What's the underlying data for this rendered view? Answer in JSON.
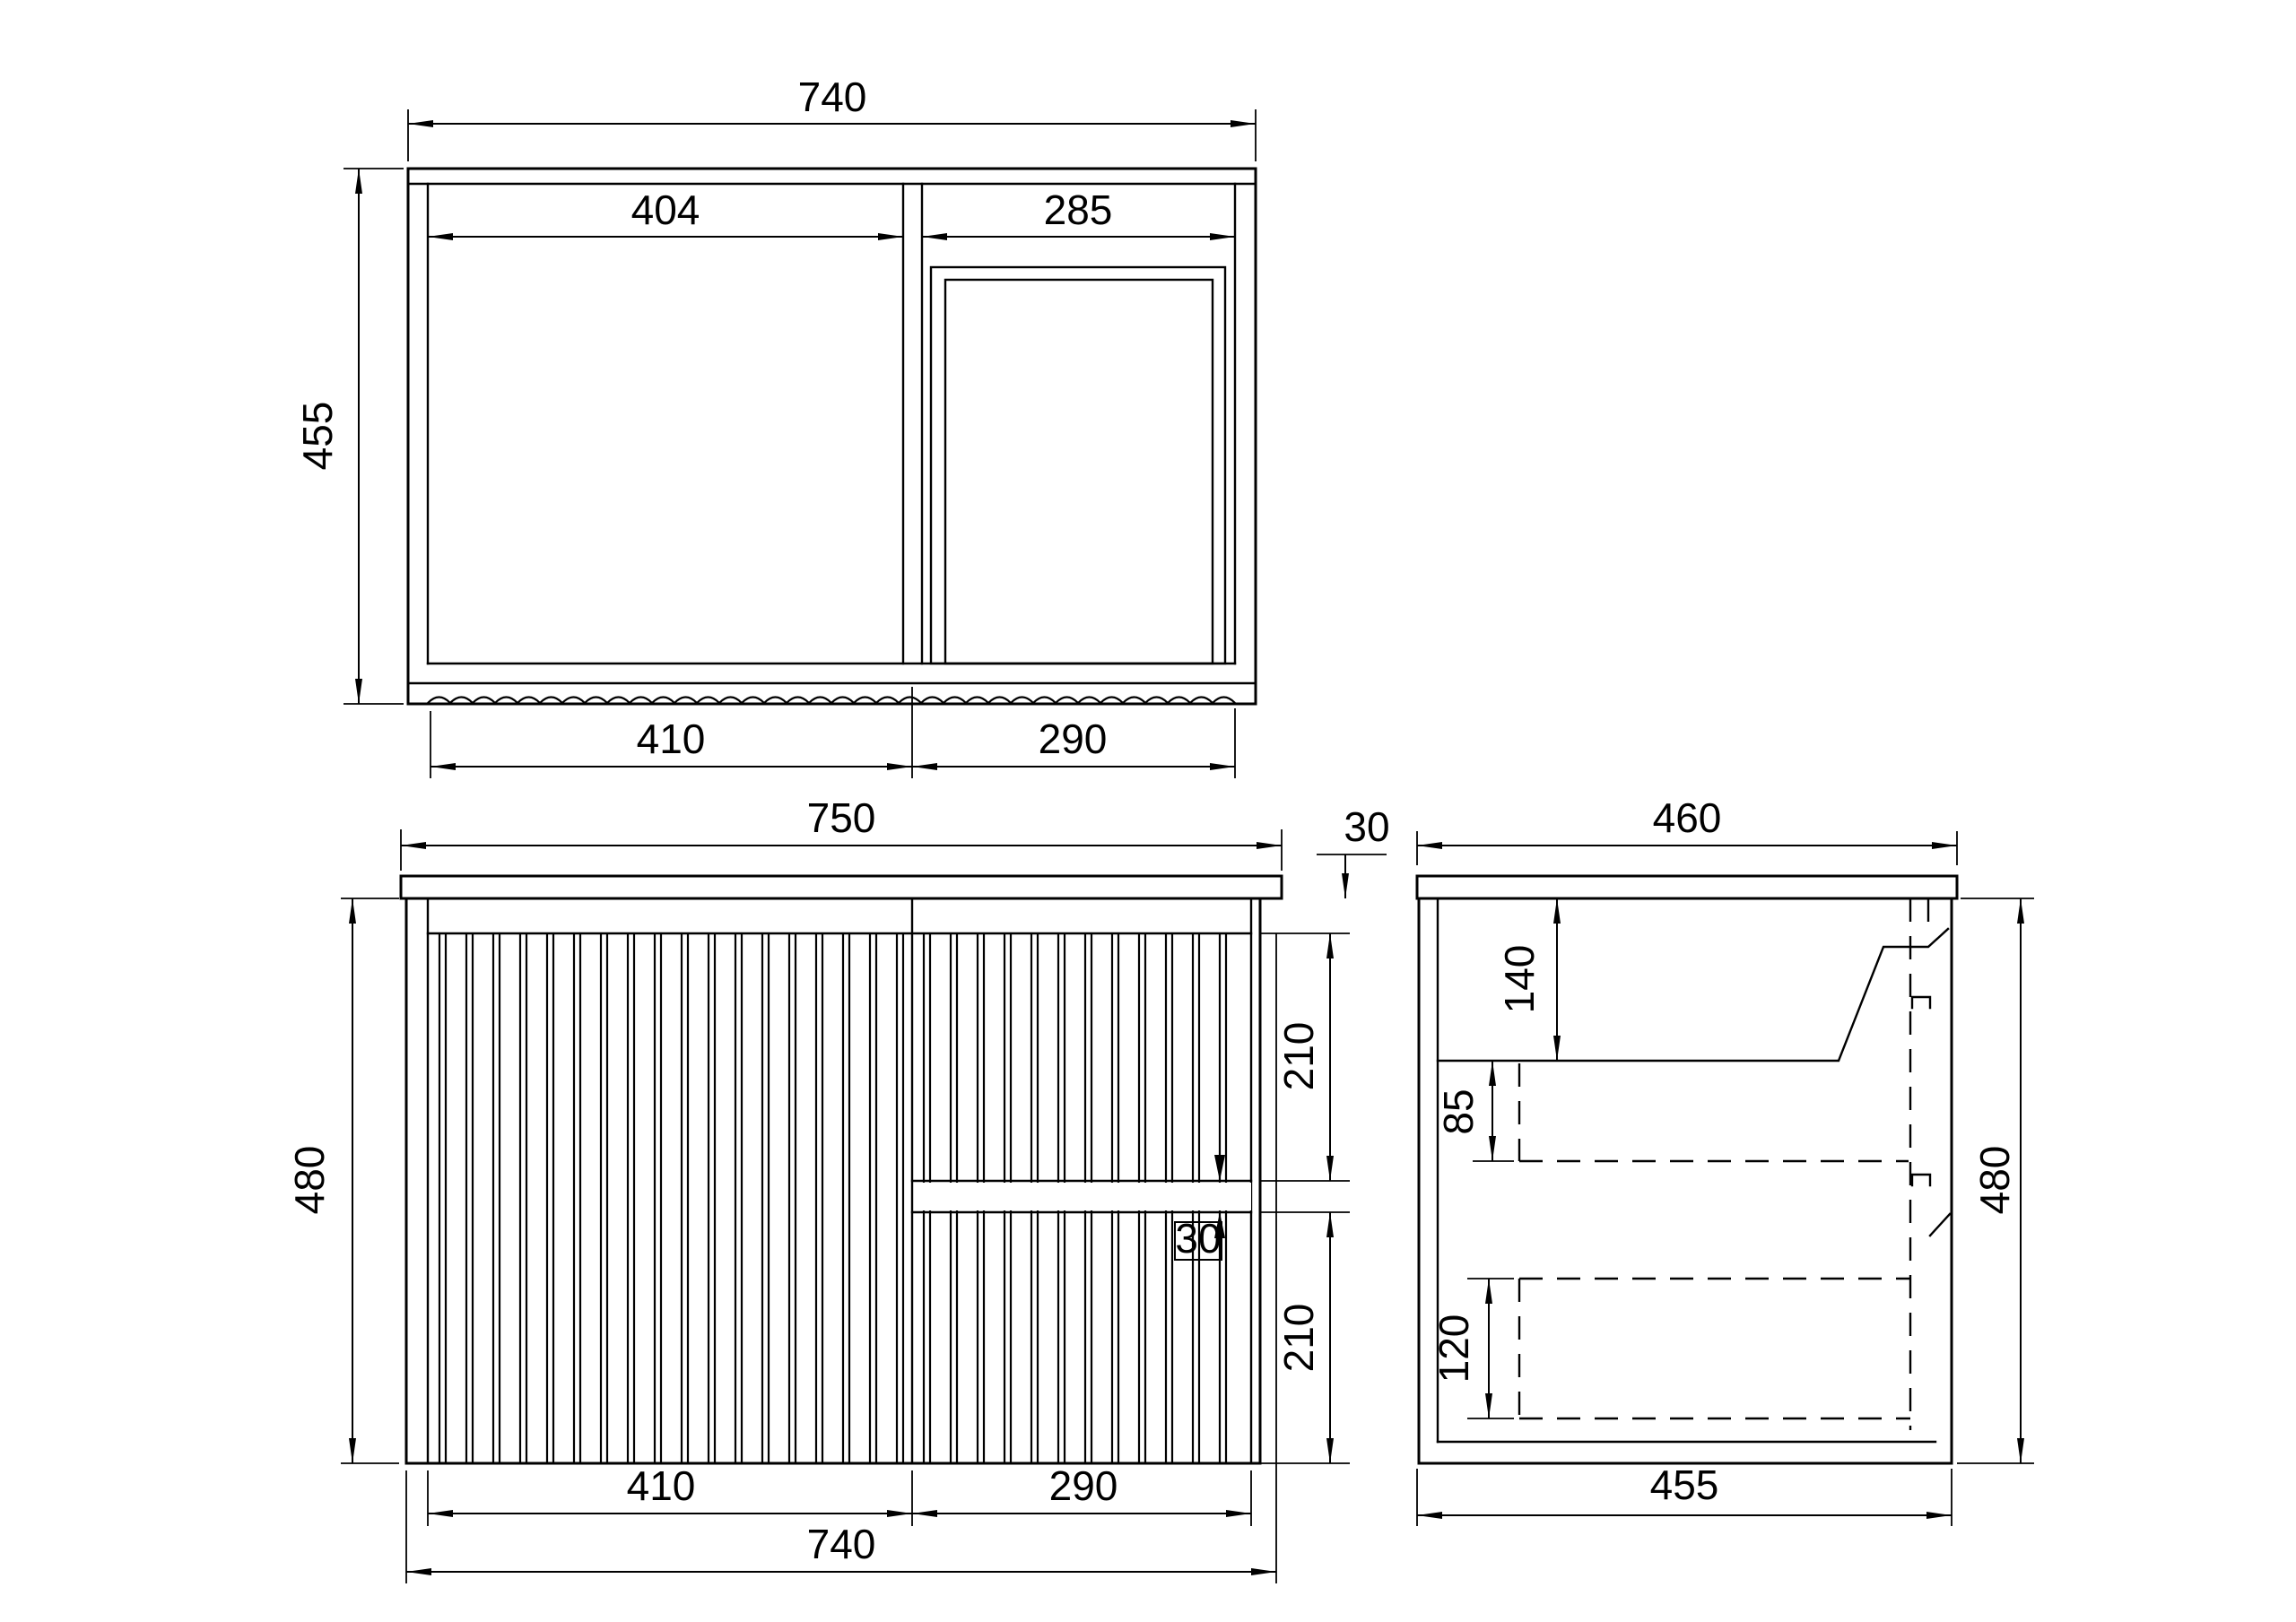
{
  "drawing": {
    "background_color": "#ffffff",
    "line_color": "#000000",
    "views": {
      "top": {
        "dims": {
          "overall_width": "740",
          "overall_depth": "455",
          "left_opening_width": "404",
          "right_opening_width": "285",
          "left_door_width": "410",
          "right_door_width": "290"
        }
      },
      "front": {
        "dims": {
          "countertop_width": "750",
          "countertop_thickness": "30",
          "body_height": "480",
          "upper_drawer_height": "210",
          "drawer_gap": "30",
          "lower_drawer_height": "210",
          "door_width": "410",
          "drawer_width": "290",
          "body_width": "740"
        }
      },
      "side": {
        "dims": {
          "countertop_depth": "460",
          "basin_depth": "140",
          "runner_clearance": "85",
          "lower_drawer_height": "120",
          "body_depth": "455",
          "body_height": "480"
        }
      }
    }
  }
}
